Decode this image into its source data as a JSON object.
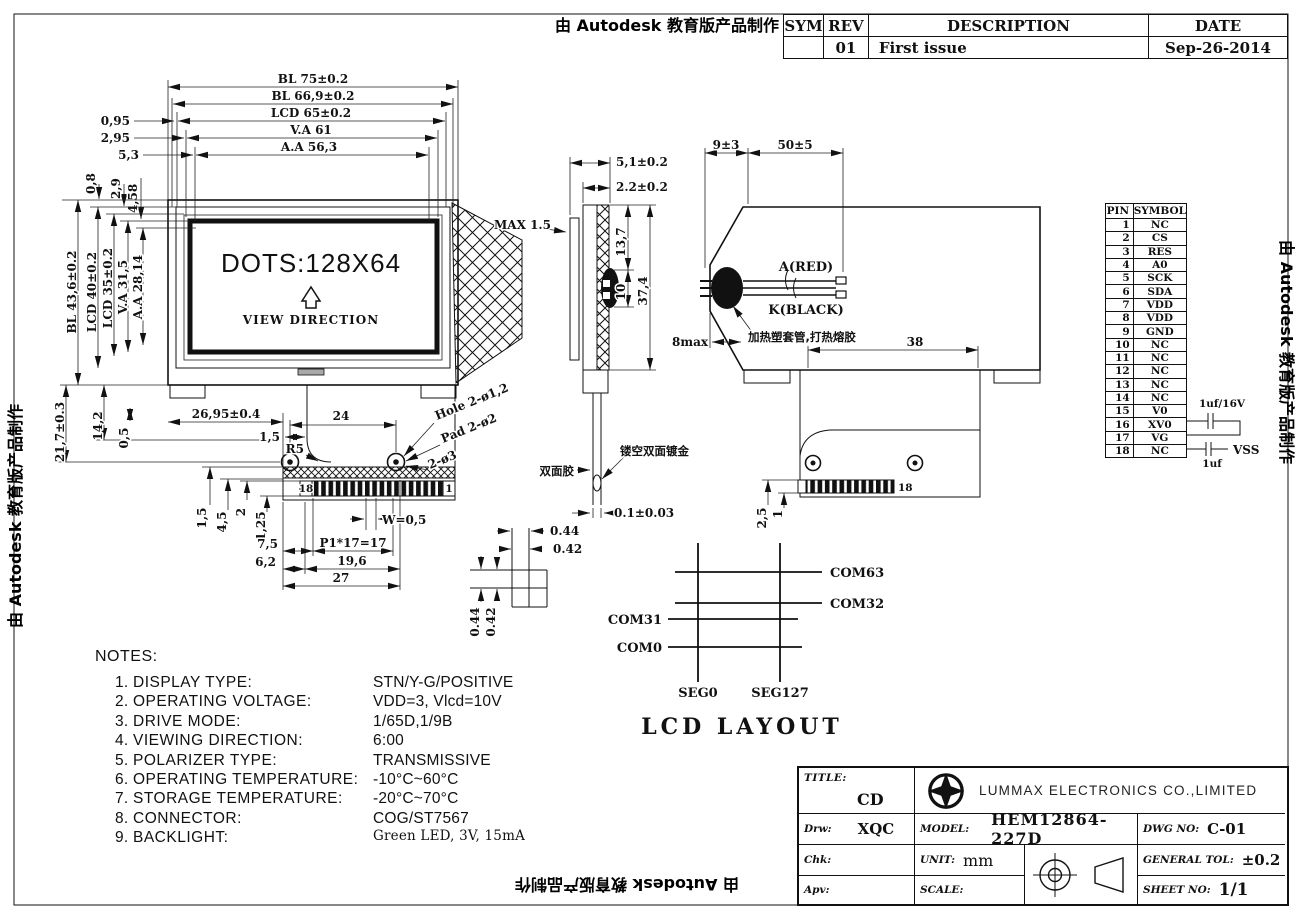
{
  "watermark": "由 Autodesk 教育版产品制作",
  "revision_table": {
    "headers": {
      "sym": "SYM",
      "rev": "REV",
      "description": "DESCRIPTION",
      "date": "DATE"
    },
    "row": {
      "sym": "",
      "rev": "01",
      "description": "First issue",
      "date": "Sep-26-2014"
    }
  },
  "front_view": {
    "dots": "DOTS:128X64",
    "view_direction": "VIEW DIRECTION"
  },
  "dims": {
    "fv_bl_w": "BL 75±0.2",
    "fv_bl2_w": "BL 66,9±0.2",
    "fv_lcd_w": "LCD 65±0.2",
    "fv_va_w": "V.A 61",
    "fv_aa_w": "A.A 56,3",
    "fv_off1": "0,95",
    "fv_off2": "2,95",
    "fv_off3": "5,3",
    "fv_off4": "2,9",
    "fv_off5": "4,58",
    "fv_off6": "0,8",
    "fv_bl_h": "BL 43,6±0.2",
    "fv_lcd_h": "LCD 40±0.2",
    "fv_lcd2_h": "LCD 35±0.2",
    "fv_va_h": "V.A 31,5",
    "fv_aa_h": "A.A 28,14",
    "fv_tail_h": "21,7±0.3",
    "fv_d142": "14,2",
    "fv_d05": "0,5",
    "fv_d2695": "26,95±0.4",
    "fv_d15a": "1,5",
    "fv_d24": "24",
    "fv_r5": "R5",
    "fv_hole": "Hole 2-ø1,2",
    "fv_pad": "Pad 2-ø2",
    "fv_2o3": "2-ø3",
    "fv_d15b": "1,5",
    "fv_d45": "4,5",
    "fv_d2": "2",
    "fv_d125": "1,25",
    "fv_w05": "W=0,5",
    "fv_d75": "7,5",
    "fv_p17": "P1*17=17",
    "fv_d62": "6,2",
    "fv_d196": "19,6",
    "fv_d27": "27",
    "fv_pin18": "18",
    "fv_pin1": "1",
    "sv_d51": "5,1±0.2",
    "sv_d22": "2.2±0.2",
    "sv_max15": "MAX 1.5",
    "sv_d137": "13,7",
    "sv_d10": "10",
    "sv_d374": "37,4",
    "sv_d01": "0.1±0.03",
    "rv_d9": "9±3",
    "rv_d50": "50±5",
    "rv_8max": "8max",
    "rv_d38": "38",
    "rv_pin18": "18",
    "rv_d25": "2,5",
    "rv_d1": "1",
    "px_w1": "0.44",
    "px_w2": "0.42",
    "px_h1": "0.44",
    "px_h2": "0.42"
  },
  "annotations": {
    "tape": "双面胶",
    "gold": "镂空双面镀金",
    "sleeve": "加热塑套管,打热熔胶",
    "a_red": "A(RED)",
    "k_black": "K(BLACK)",
    "cap1": "1uf/16V",
    "cap2": "1uf",
    "vss": "VSS"
  },
  "pin_table": {
    "headers": {
      "pin": "PIN",
      "symbol": "SYMBOL"
    },
    "rows": [
      {
        "pin": "1",
        "symbol": "NC"
      },
      {
        "pin": "2",
        "symbol": "CS"
      },
      {
        "pin": "3",
        "symbol": "RES"
      },
      {
        "pin": "4",
        "symbol": "A0"
      },
      {
        "pin": "5",
        "symbol": "SCK"
      },
      {
        "pin": "6",
        "symbol": "SDA"
      },
      {
        "pin": "7",
        "symbol": "VDD"
      },
      {
        "pin": "8",
        "symbol": "VDD"
      },
      {
        "pin": "9",
        "symbol": "GND"
      },
      {
        "pin": "10",
        "symbol": "NC"
      },
      {
        "pin": "11",
        "symbol": "NC"
      },
      {
        "pin": "12",
        "symbol": "NC"
      },
      {
        "pin": "13",
        "symbol": "NC"
      },
      {
        "pin": "14",
        "symbol": "NC"
      },
      {
        "pin": "15",
        "symbol": "V0"
      },
      {
        "pin": "16",
        "symbol": "XV0"
      },
      {
        "pin": "17",
        "symbol": "VG"
      },
      {
        "pin": "18",
        "symbol": "NC"
      }
    ]
  },
  "lcd_layout": {
    "title": "LCD LAYOUT",
    "com63": "COM63",
    "com32": "COM32",
    "com31": "COM31",
    "com0": "COM0",
    "seg0": "SEG0",
    "seg127": "SEG127"
  },
  "notes": {
    "title": "NOTES:",
    "items": [
      {
        "num": "1.",
        "label": "DISPLAY TYPE:",
        "value": "STN/Y-G/POSITIVE"
      },
      {
        "num": "2.",
        "label": "OPERATING VOLTAGE:",
        "value": "VDD=3, Vlcd=10V"
      },
      {
        "num": "3.",
        "label": "DRIVE MODE:",
        "value": "1/65D,1/9B"
      },
      {
        "num": "4.",
        "label": "VIEWING DIRECTION:",
        "value": "6:00"
      },
      {
        "num": "5.",
        "label": "POLARIZER TYPE:",
        "value": "TRANSMISSIVE"
      },
      {
        "num": "6.",
        "label": "OPERATING TEMPERATURE:",
        "value": "-10°C~60°C"
      },
      {
        "num": "7.",
        "label": "STORAGE TEMPERATURE:",
        "value": "-20°C~70°C"
      },
      {
        "num": "8.",
        "label": "CONNECTOR:",
        "value": "COG/ST7567"
      },
      {
        "num": "9.",
        "label": "BACKLIGHT:",
        "value": "Green LED, 3V, 15mA"
      }
    ]
  },
  "title_block": {
    "title_label": "TITLE:",
    "title": "CD",
    "company": "LUMMAX ELECTRONICS CO.,LIMITED",
    "drw_label": "Drw:",
    "drw": "XQC",
    "model_label": "MODEL:",
    "model": "HEM12864-227D",
    "dwg_label": "DWG NO:",
    "dwg": "C-01",
    "chk_label": "Chk:",
    "chk": "",
    "unit_label": "UNIT:",
    "unit": "mm",
    "tol_label": "GENERAL TOL:",
    "tol": "±0.2",
    "apv_label": "Apv:",
    "apv": "",
    "scale_label": "SCALE:",
    "scale": "",
    "sheet_label": "SHEET NO:",
    "sheet": "1/1"
  }
}
